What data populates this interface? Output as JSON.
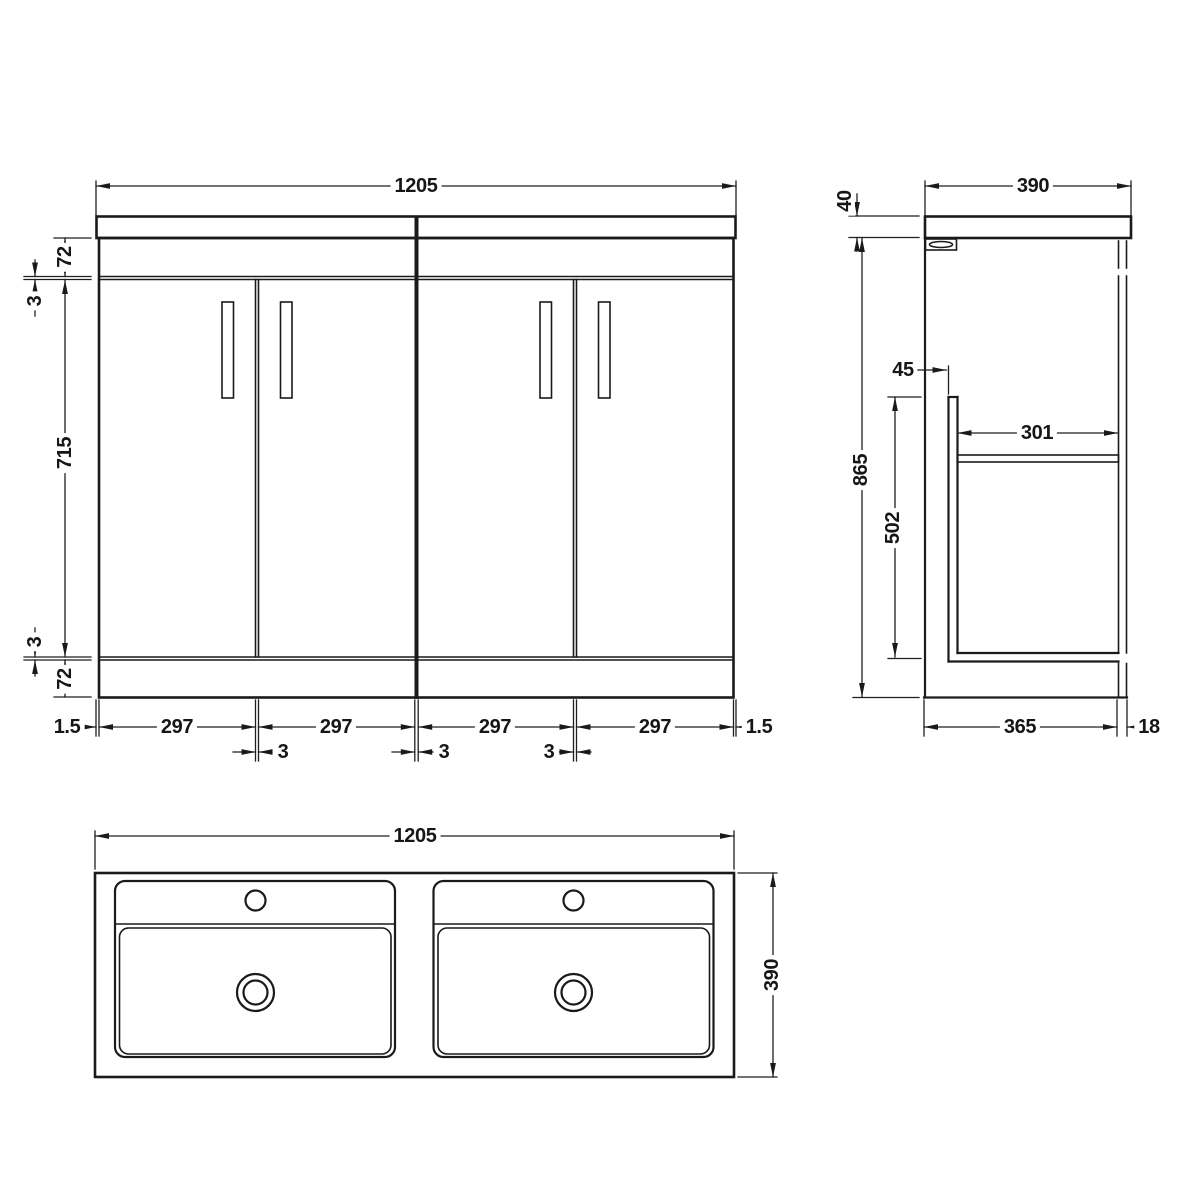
{
  "drawing": {
    "colors": {
      "line": "#1a1a1a",
      "background": "#ffffff"
    }
  },
  "front_view": {
    "overall_width": "1205",
    "top_rail_height": "72",
    "top_gap": "3",
    "door_height": "715",
    "bottom_gap": "3",
    "plinth_height": "72",
    "worktop_overhang_left": "1.5",
    "worktop_overhang_right": "1.5",
    "door_widths": [
      "297",
      "297",
      "297",
      "297"
    ],
    "door_gaps": [
      "3",
      "3",
      "3"
    ]
  },
  "side_view": {
    "worktop_thickness": "40",
    "overall_depth": "390",
    "door_setback": "45",
    "carcase_height": "865",
    "internal_depth": "301",
    "internal_height": "502",
    "base_depth": "365",
    "back_panel_thickness": "18"
  },
  "plan_view": {
    "overall_width": "1205",
    "overall_depth": "390"
  }
}
